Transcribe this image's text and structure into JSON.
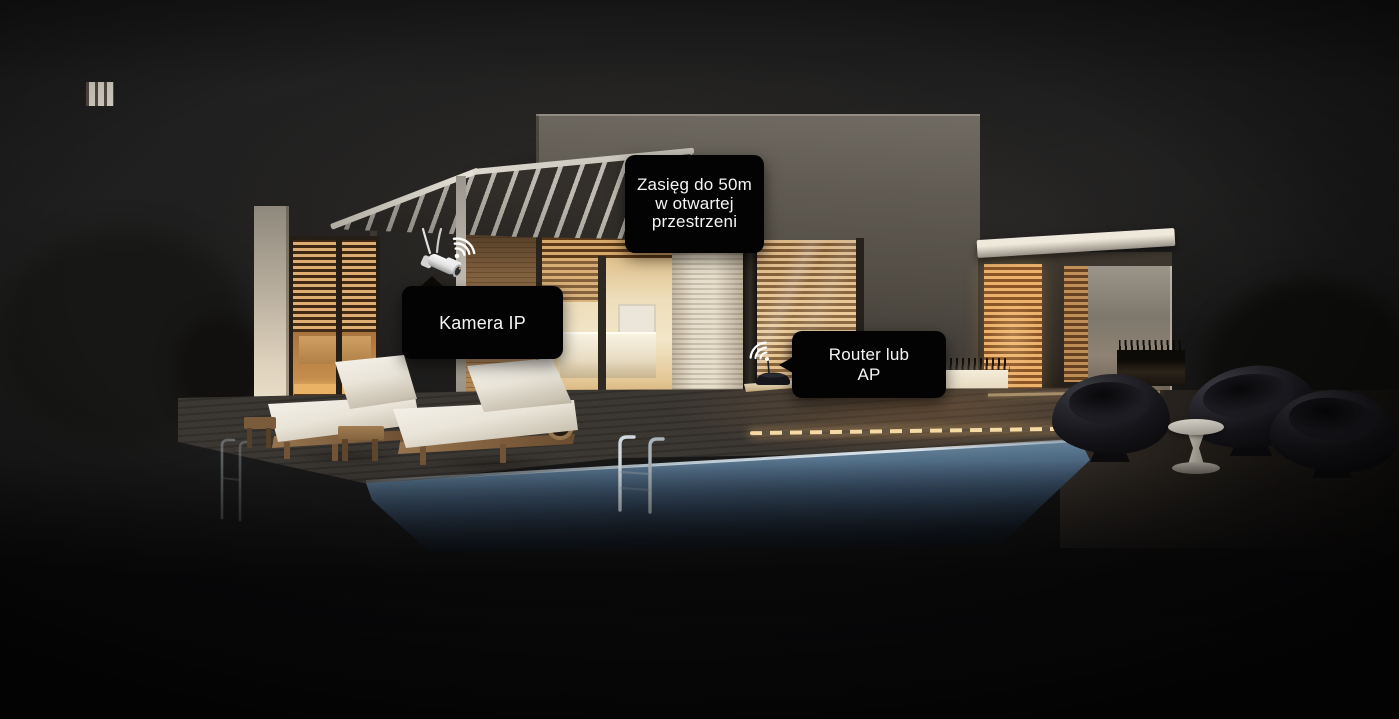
{
  "labels": {
    "range": {
      "line1": "Zasięg do 50m",
      "line2": "w otwartej",
      "line3": "przestrzeni"
    },
    "camera": {
      "text": "Kamera IP"
    },
    "router": {
      "line1": "Router lub",
      "line2": "AP"
    }
  },
  "icons": {
    "camera": "wifi-ip-camera-icon",
    "router": "wifi-router-icon"
  },
  "colors": {
    "label_background": "#030303",
    "label_text": "#f4f4f4",
    "wifi_signal": "#ffffff",
    "interior_glow": "#e8c183",
    "pool_water": "#7c93a6",
    "night_sky": "#1d1d1d"
  }
}
